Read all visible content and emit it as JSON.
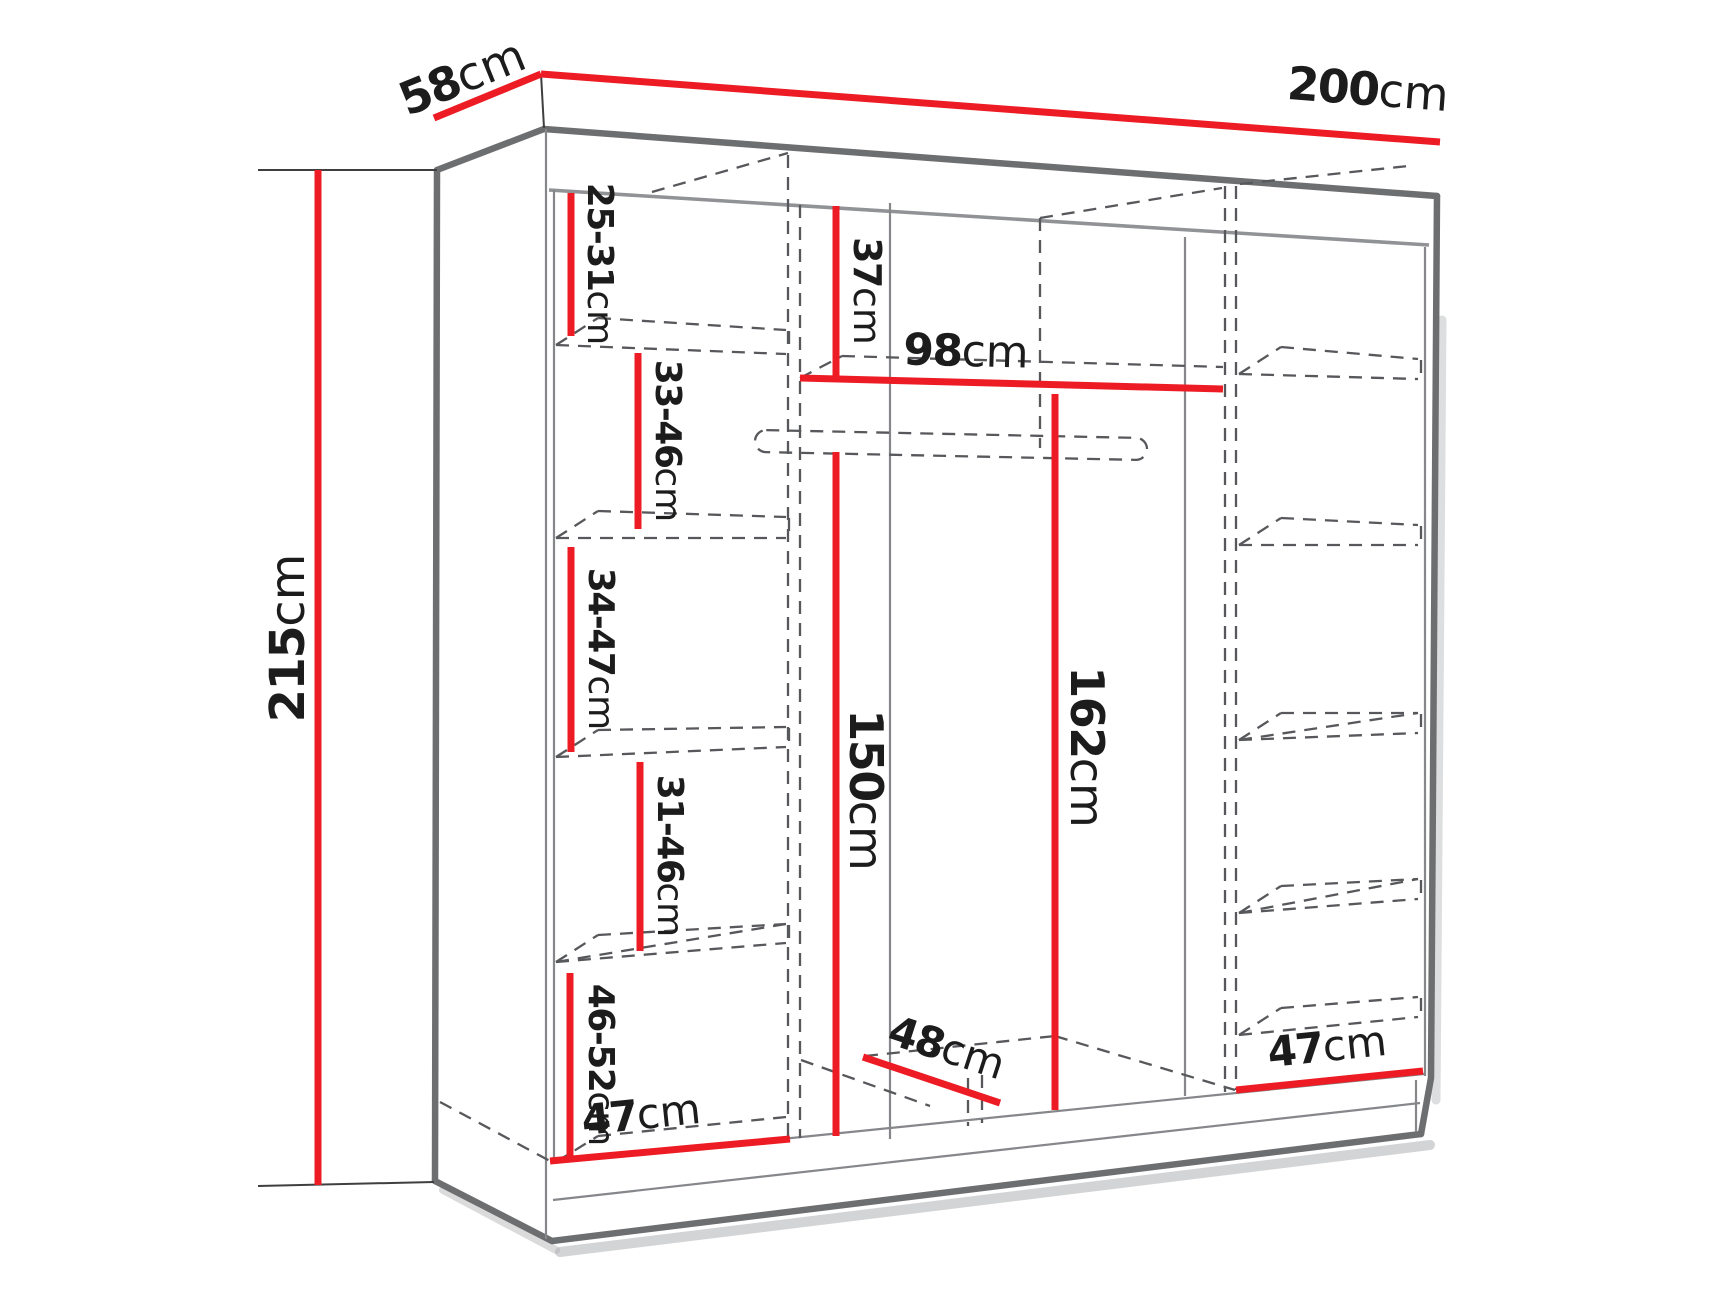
{
  "diagram": {
    "title": "wardrobe-dimensions",
    "unit": "cm",
    "colors": {
      "dimension_line": "#ed1c24",
      "edge_dark": "#6d6e70",
      "edge_light": "#909295",
      "hidden_line": "#57585b",
      "label_text": "#1c1c1c"
    },
    "overall": {
      "width": {
        "value": "200",
        "unit": "cm"
      },
      "depth": {
        "value": "58",
        "unit": "cm"
      },
      "height": {
        "value": "215",
        "unit": "cm"
      }
    },
    "interior": {
      "left_column_shelf_gaps": [
        {
          "value": "25-31",
          "unit": "cm"
        },
        {
          "value": "33-46",
          "unit": "cm"
        },
        {
          "value": "34-47",
          "unit": "cm"
        },
        {
          "value": "31-46",
          "unit": "cm"
        },
        {
          "value": "46-52",
          "unit": "cm"
        }
      ],
      "middle_section": {
        "top_gap": {
          "value": "37",
          "unit": "cm"
        },
        "width": {
          "value": "98",
          "unit": "cm"
        },
        "hanging_height": {
          "value": "150",
          "unit": "cm"
        },
        "side_height": {
          "value": "162",
          "unit": "cm"
        },
        "floor_depth": {
          "value": "48",
          "unit": "cm"
        }
      },
      "left_section_floor_width": {
        "value": "47",
        "unit": "cm"
      },
      "right_section_floor_width": {
        "value": "47",
        "unit": "cm"
      }
    }
  }
}
